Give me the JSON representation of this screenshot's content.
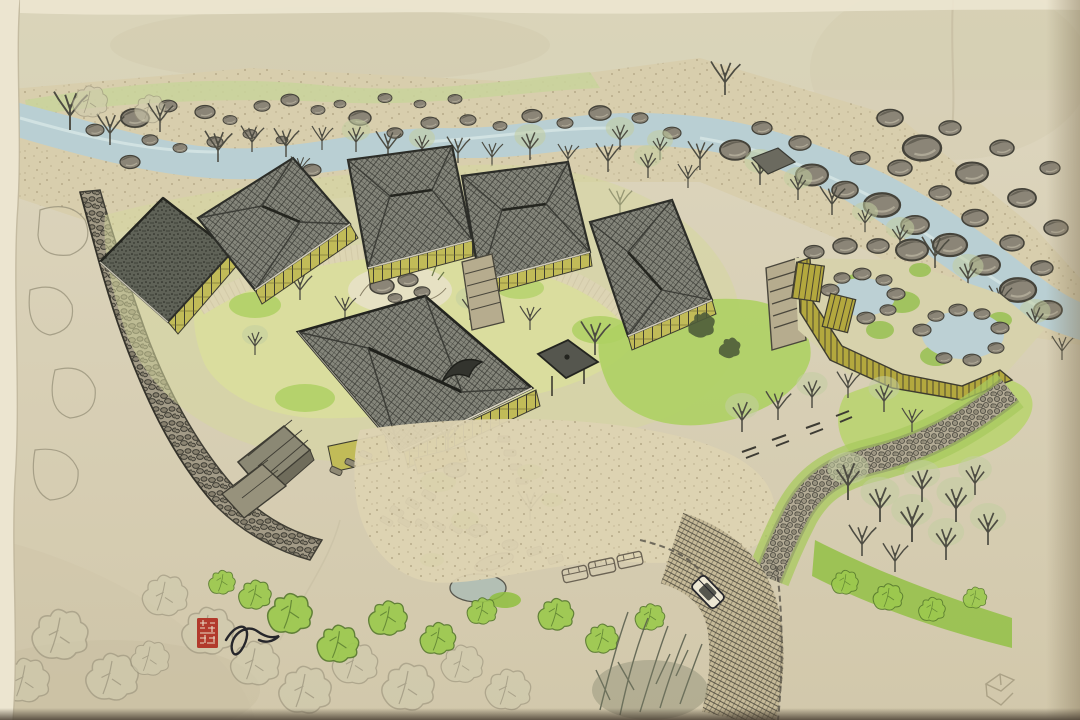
{
  "artwork": {
    "kind": "hand-drawn aerial site rendering (ink and watercolor on toned paper)",
    "subject": "Japanese hot-spring inn complex: hip-roofed pavilions around a garden courtyard beside a boulder-strewn mountain river, with fenced open-air bath pools, winding stone paths, tree groves, an access road with cars, and a red artist seal with signature flourish",
    "visible_text": "none (illegible carved seal characters only)"
  },
  "scene": {
    "river": "mountain stream with scattered gray boulders flowing from upper left to right edge",
    "far_bank": "pale green bank with bare winter trees and a small hut",
    "courtyard": "central garden lawn with rock arrangement ringed by five hip-roofed guest pavilions",
    "main_hall": "large hipped tile roof with curved eyebrow dormer",
    "gazebo": "small square pavilion with pyramidal roof",
    "sheds": "two plank-roofed outbuildings at lower left",
    "baths": "two rock-edged hot-spring pools inside an olive fence enclosure",
    "stone_walk": "winding cobble path from the baths down the slope",
    "road": "cross-hatched driveway with one drawn car and three faint car outlines in the forecourt",
    "signature": "red square seal with black ink flourish at lower left",
    "corner_sketch": "faint unfinished pencil cube at lower right"
  },
  "palette": {
    "paper_top": "#ded7c0",
    "paper_bottom": "#d2c8ab",
    "paper_edge": "#ece5d0",
    "edge_shadow": "#8a7c5f",
    "bottom_shadow": "#4a4034",
    "water": "#b9cfd3",
    "water_light": "#dce9e8",
    "gravel": "#d8cead",
    "gravel_dot": "#8b7c5a",
    "rock": "#8b8577",
    "rock_dark": "#5c594d",
    "rock_line": "#45433a",
    "bank_green": "#c9d49b",
    "lawn_pale": "#dadd9e",
    "lawn_bright": "#aed063",
    "shrub_green": "#8fbf3f",
    "canopy_pencil": "#d0cbae",
    "canopy_line": "#98917a",
    "tree_pale": "#c2cda0",
    "ginkgo": "#9cc94e",
    "ginkgo_line": "#587a2e",
    "conifer": "#4e5c3a",
    "branch": "#4d4c42",
    "roof_base": "#85867b",
    "roof_line": "#3c3d37",
    "roof_dark": "#5f6257",
    "roof_dot": "#24251f",
    "eave_light": "#ece7d3",
    "wall_olive": "#c1bb58",
    "wall_line": "#3e3d30",
    "stone_bg": "#a39b87",
    "stone_line": "#403e35",
    "stone_fill": "#867f6d",
    "cobble_bg": "#b3ab95",
    "cobble_line": "#4c4a40",
    "cobble_fill": "#97917e",
    "road_bg": "#c6ba98",
    "road_line": "#3e3b32",
    "fence": "#b3a83e",
    "fence_line": "#4a4430",
    "pond": "#bcd0d4",
    "entry_pond": "#b3bfb4",
    "paving": "#8f8974",
    "paving_line": "#4b483d",
    "pencil": "#9a937c",
    "ink": "#26262b",
    "seal_red": "#b23a2c",
    "seal_glyph": "#e8d9c4"
  }
}
